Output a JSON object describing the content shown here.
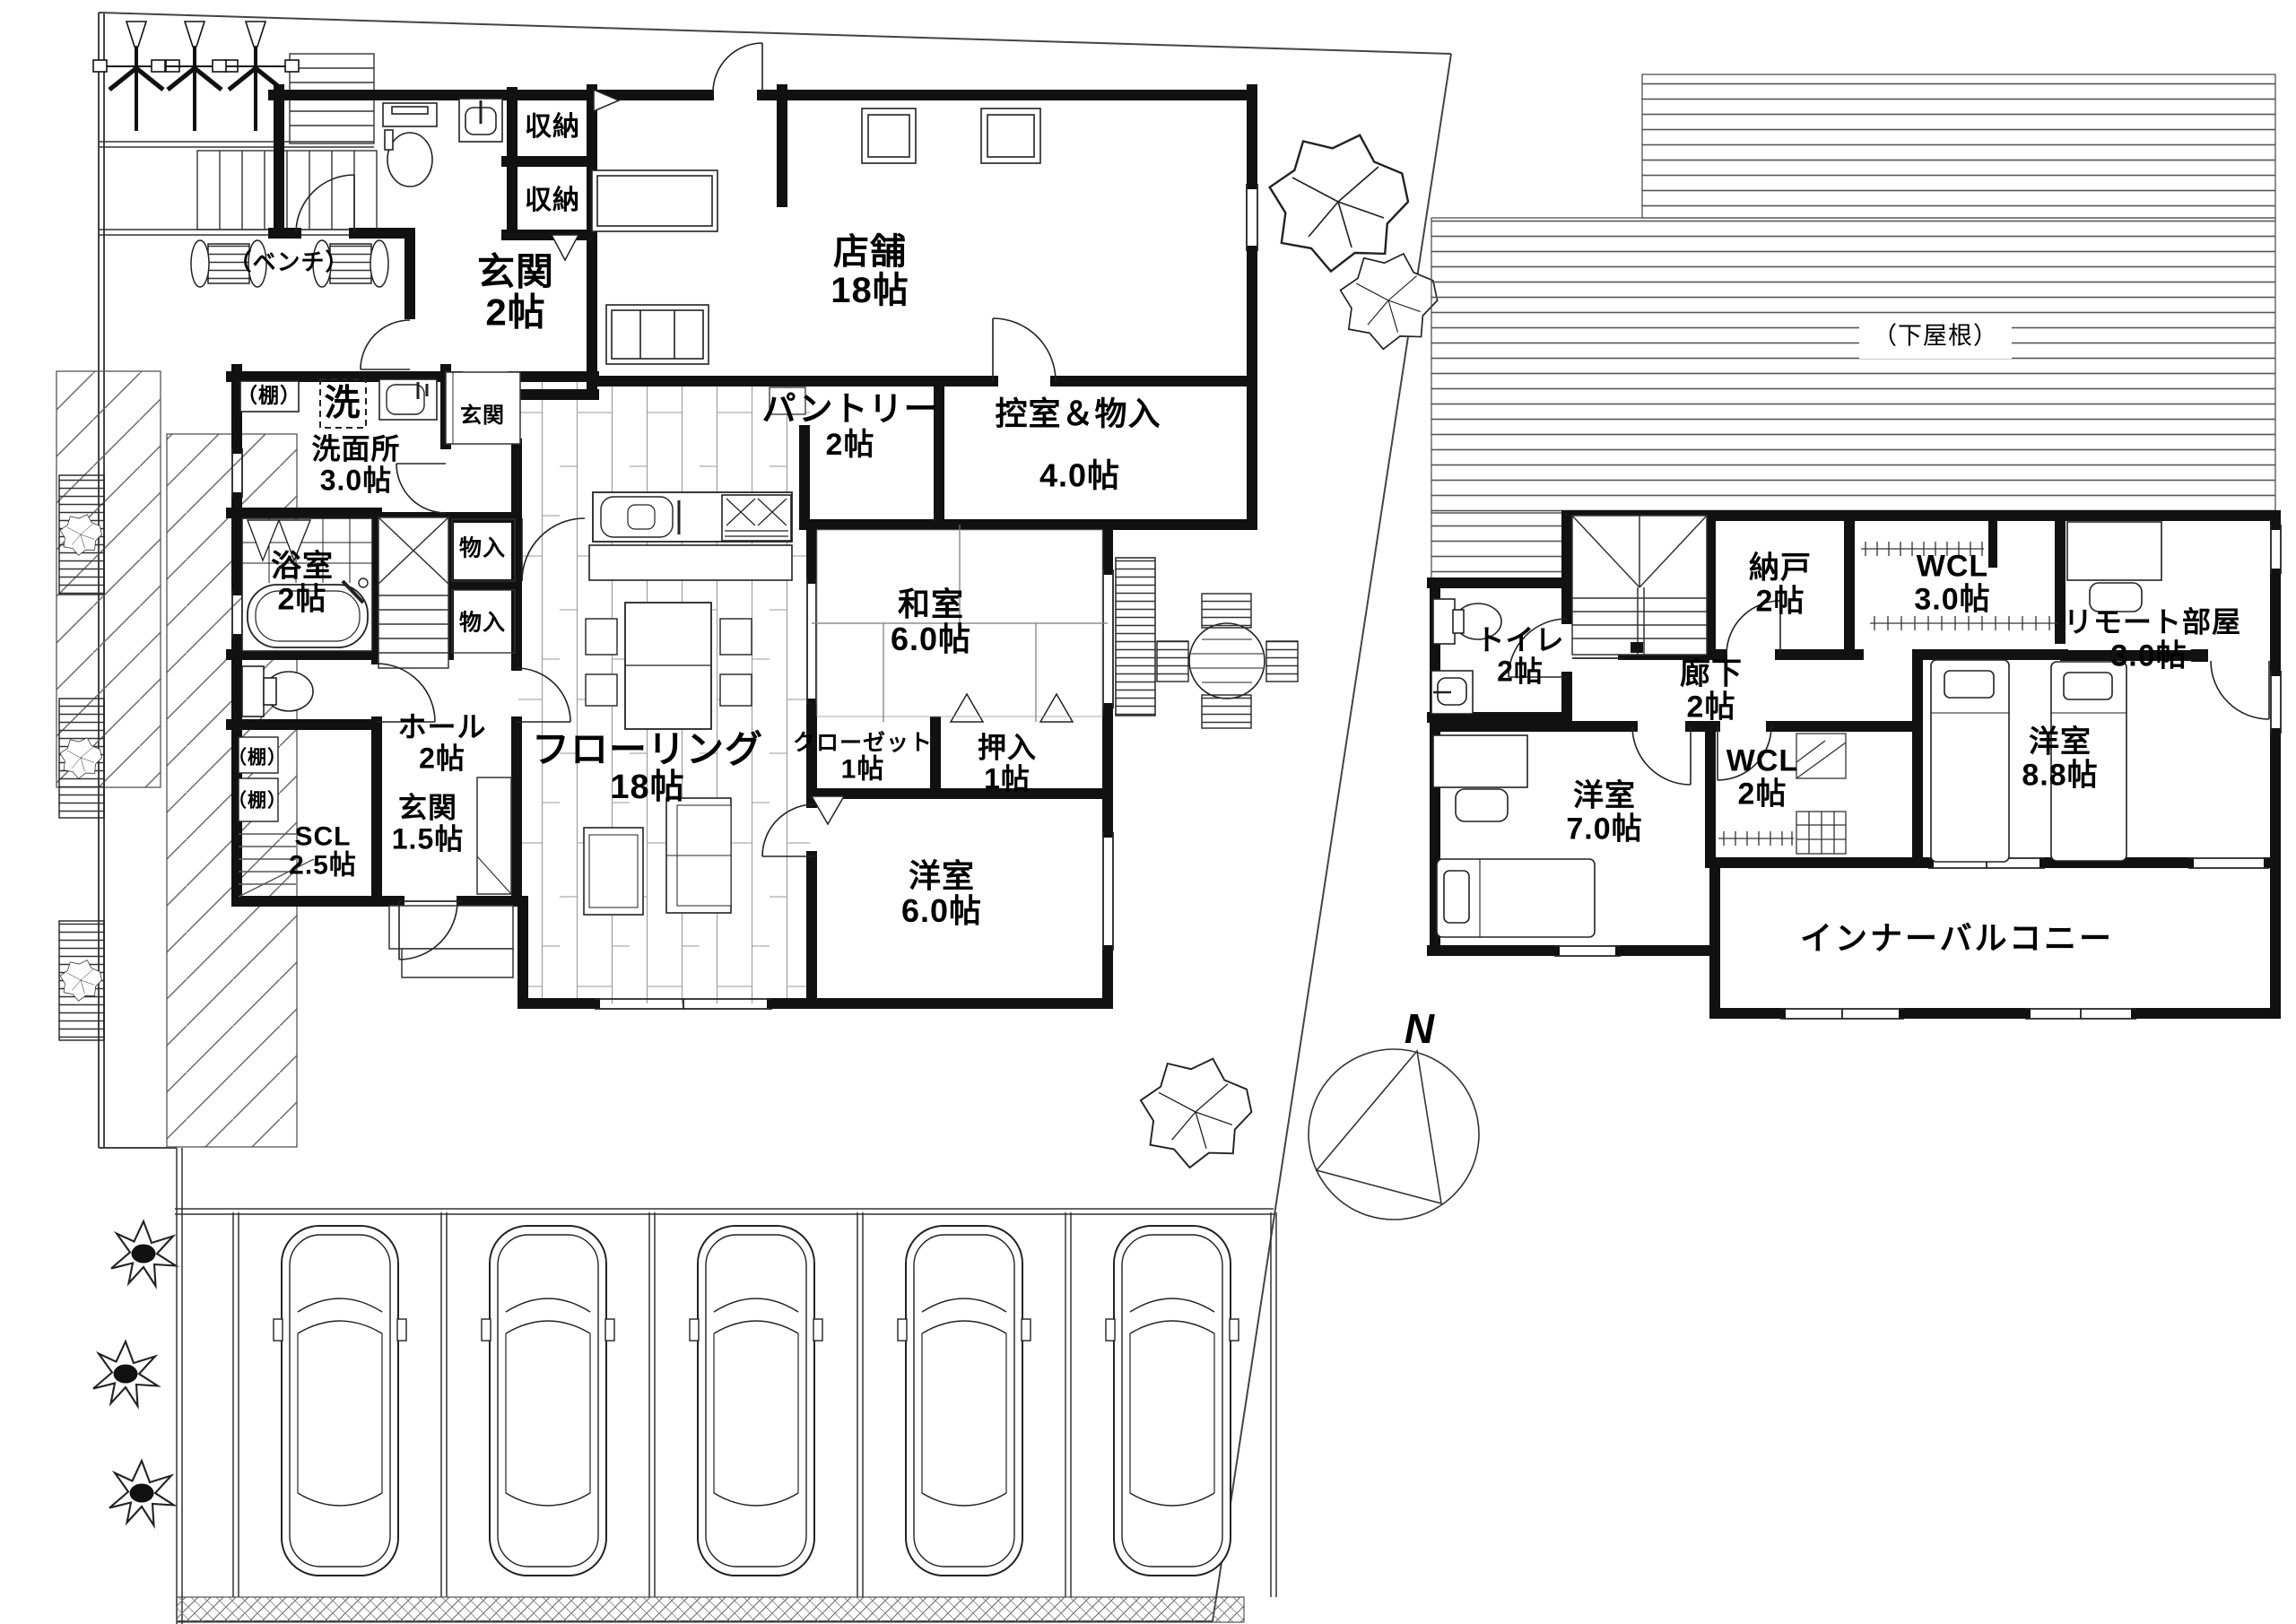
{
  "meta": {
    "drawing_type": "floor-plan",
    "floors": [
      "1F",
      "2F"
    ],
    "ink_color": "#111111",
    "paper_color": "#ffffff"
  },
  "labels": {
    "bench": "（ベンチ）",
    "shelf": "（棚）",
    "lower_roof": "（下屋根）",
    "north": "N",
    "laundry": "洗",
    "entry_step": "玄関",
    "storage_shuno": "収納",
    "storage_mono": "物入"
  },
  "f1": {
    "rooms": [
      {
        "name": "玄関",
        "size": "2帖"
      },
      {
        "name": "店舗",
        "size": "18帖"
      },
      {
        "name": "パントリー",
        "size": "2帖"
      },
      {
        "name": "控室＆物入",
        "size": "4.0帖"
      },
      {
        "name": "洗面所",
        "size": "3.0帖"
      },
      {
        "name": "浴室",
        "size": "2帖"
      },
      {
        "name": "ホール",
        "size": "2帖"
      },
      {
        "name": "SCL",
        "size": "2.5帖"
      },
      {
        "name": "玄関",
        "size": "1.5帖"
      },
      {
        "name": "フローリング",
        "size": "18帖"
      },
      {
        "name": "和室",
        "size": "6.0帖"
      },
      {
        "name": "クローゼット",
        "size": "1帖"
      },
      {
        "name": "押入",
        "size": "1帖"
      },
      {
        "name": "洋室",
        "size": "6.0帖"
      }
    ]
  },
  "f2": {
    "rooms": [
      {
        "name": "トイレ",
        "size": "2帖"
      },
      {
        "name": "納戸",
        "size": "2帖"
      },
      {
        "name": "廊下",
        "size": "2帖"
      },
      {
        "name": "WCL",
        "size": "3.0帖"
      },
      {
        "name": "リモート部屋",
        "size": "3.0帖"
      },
      {
        "name": "WCL",
        "size": "2帖"
      },
      {
        "name": "洋室",
        "size": "7.0帖"
      },
      {
        "name": "洋室",
        "size": "8.8帖"
      },
      {
        "name": "インナーバルコニー",
        "size": ""
      }
    ]
  }
}
